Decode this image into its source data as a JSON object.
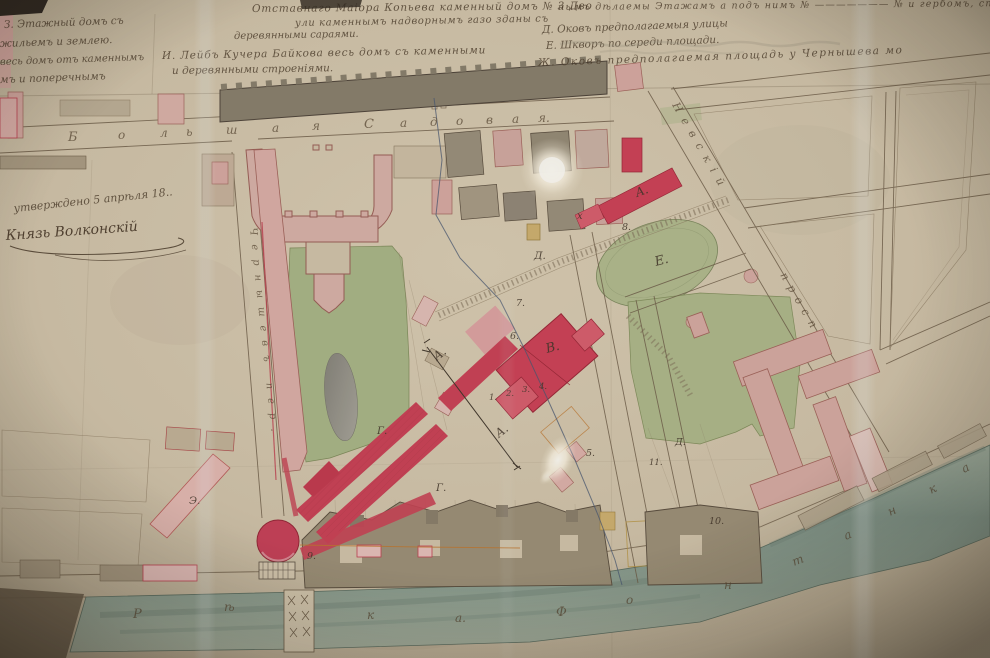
{
  "legend": {
    "left": [
      {
        "t": "З. Этажный домъ съ",
        "x": 4,
        "y": 28,
        "s": 10.5,
        "r": -2
      },
      {
        "t": "жильемъ и землею.",
        "x": 0,
        "y": 47,
        "s": 10.5,
        "r": -2
      },
      {
        "t": "весь домъ отъ каменнымъ",
        "x": 0,
        "y": 65,
        "s": 10,
        "r": -2
      },
      {
        "t": "мъ и поперечнымъ",
        "x": 0,
        "y": 83,
        "s": 10.5,
        "r": -2
      }
    ],
    "center": [
      {
        "t": "Отставнаго Маіора Копьева каменный домъ № 3 Дво",
        "x": 252,
        "y": 12,
        "s": 10.5,
        "r": -0.5,
        "ls": 0.8
      },
      {
        "t": "ули каменнымъ надворнымъ газо зданы съ",
        "x": 295,
        "y": 26,
        "s": 10,
        "r": -1,
        "ls": 0.6
      },
      {
        "t": "деревянными сараями.",
        "x": 234,
        "y": 39,
        "s": 10,
        "r": -1
      },
      {
        "t": "И. Лейбъ Кучера Байкова весь домъ съ каменными",
        "x": 162,
        "y": 59,
        "s": 10.5,
        "r": -1,
        "ls": 0.8
      },
      {
        "t": "и деревянными строеніями.",
        "x": 172,
        "y": 74,
        "s": 10.5,
        "r": -1
      }
    ],
    "right": [
      {
        "t": "нымъ дѣлаемы Этажамъ а подъ нимъ № ——————— № и гербомъ, спр",
        "x": 558,
        "y": 10,
        "s": 9.5,
        "r": -0.5,
        "ls": 1.2
      },
      {
        "t": "Д. Оковъ предполагаемыя улицы",
        "x": 542,
        "y": 33,
        "s": 10.5,
        "r": -2
      },
      {
        "t": "Е. Шкворъ по середи площади.",
        "x": 546,
        "y": 49,
        "s": 10.5,
        "r": -2
      },
      {
        "t": "Ж. Оковъ предполагаемая площадь у Чернышева мо",
        "x": 538,
        "y": 66,
        "s": 10.5,
        "r": -2,
        "ls": 1.5
      }
    ]
  },
  "approval": {
    "line1": "утверждено 5 апрѣля 18..",
    "line2": "Князь Волконскій"
  },
  "street_letters": [
    {
      "t": "Б",
      "x": 68,
      "y": 141,
      "s": 13
    },
    {
      "t": "о",
      "x": 118,
      "y": 139,
      "s": 12
    },
    {
      "t": "л",
      "x": 160,
      "y": 137,
      "s": 12
    },
    {
      "t": "ь",
      "x": 186,
      "y": 136,
      "s": 12
    },
    {
      "t": "ш",
      "x": 226,
      "y": 134,
      "s": 12
    },
    {
      "t": "а",
      "x": 272,
      "y": 132,
      "s": 12
    },
    {
      "t": "я",
      "x": 312,
      "y": 130,
      "s": 12
    },
    {
      "t": "С",
      "x": 364,
      "y": 128,
      "s": 13
    },
    {
      "t": "а",
      "x": 400,
      "y": 127,
      "s": 12
    },
    {
      "t": "д",
      "x": 430,
      "y": 126,
      "s": 12
    },
    {
      "t": "о",
      "x": 456,
      "y": 125,
      "s": 12
    },
    {
      "t": "в",
      "x": 486,
      "y": 124,
      "s": 12
    },
    {
      "t": "а",
      "x": 512,
      "y": 123,
      "s": 12
    },
    {
      "t": "я.",
      "x": 538,
      "y": 122,
      "s": 12
    },
    {
      "t": "Чернышевъ пер.",
      "x": 250,
      "y": 228,
      "s": 10,
      "r": 84,
      "ls": 9
    },
    {
      "t": "Невскій",
      "x": 672,
      "y": 105,
      "s": 11,
      "r": 60,
      "ls": 8
    },
    {
      "t": "просп",
      "x": 780,
      "y": 275,
      "s": 11,
      "r": 60,
      "ls": 7
    },
    {
      "t": "Р",
      "x": 133,
      "y": 618,
      "s": 13
    },
    {
      "t": "ѣ",
      "x": 224,
      "y": 611,
      "s": 12
    },
    {
      "t": "к",
      "x": 367,
      "y": 619,
      "s": 12
    },
    {
      "t": "а.",
      "x": 455,
      "y": 622,
      "s": 12
    },
    {
      "t": "Ф",
      "x": 556,
      "y": 616,
      "s": 13
    },
    {
      "t": "о",
      "x": 626,
      "y": 604,
      "s": 12
    },
    {
      "t": "н",
      "x": 724,
      "y": 589,
      "s": 12
    },
    {
      "t": "т",
      "x": 794,
      "y": 566,
      "s": 12,
      "r": -22
    },
    {
      "t": "а",
      "x": 846,
      "y": 540,
      "s": 12,
      "r": -24
    },
    {
      "t": "н",
      "x": 890,
      "y": 516,
      "s": 12,
      "r": -25
    },
    {
      "t": "к",
      "x": 931,
      "y": 494,
      "s": 12,
      "r": -26
    },
    {
      "t": "а",
      "x": 964,
      "y": 473,
      "s": 12,
      "r": -27
    }
  ],
  "map_labels": [
    {
      "t": "А.",
      "x": 637,
      "y": 197,
      "s": 12,
      "r": -20
    },
    {
      "t": "х",
      "x": 577,
      "y": 219,
      "s": 10
    },
    {
      "t": "8.",
      "x": 622,
      "y": 230,
      "s": 9.5
    },
    {
      "t": "Д.",
      "x": 534,
      "y": 259,
      "s": 10.5
    },
    {
      "t": "Е.",
      "x": 656,
      "y": 266,
      "s": 13,
      "r": -15
    },
    {
      "t": "7.",
      "x": 516,
      "y": 306,
      "s": 9.5
    },
    {
      "t": "6.",
      "x": 510,
      "y": 339,
      "s": 9.5
    },
    {
      "t": "В.",
      "x": 547,
      "y": 353,
      "s": 13,
      "r": -15
    },
    {
      "t": "1.",
      "x": 489,
      "y": 400,
      "s": 8.5
    },
    {
      "t": "2.",
      "x": 506,
      "y": 396,
      "s": 8.5
    },
    {
      "t": "3.",
      "x": 522,
      "y": 392,
      "s": 8.5
    },
    {
      "t": "4.",
      "x": 539,
      "y": 389,
      "s": 8.5
    },
    {
      "t": "А.",
      "x": 437,
      "y": 361,
      "s": 12,
      "r": -38
    },
    {
      "t": "А.",
      "x": 499,
      "y": 438,
      "s": 12,
      "r": -38
    },
    {
      "t": "Г.",
      "x": 377,
      "y": 434,
      "s": 10.5
    },
    {
      "t": "Г.",
      "x": 436,
      "y": 491,
      "s": 10.5
    },
    {
      "t": "5.",
      "x": 586,
      "y": 456,
      "s": 9.5
    },
    {
      "t": "11.",
      "x": 649,
      "y": 465,
      "s": 8.5
    },
    {
      "t": "Д.",
      "x": 675,
      "y": 445,
      "s": 9.5
    },
    {
      "t": "10.",
      "x": 709,
      "y": 524,
      "s": 9.5
    },
    {
      "t": "Э.",
      "x": 189,
      "y": 504,
      "s": 10.5
    },
    {
      "t": "9.",
      "x": 307,
      "y": 559,
      "s": 9.5
    }
  ],
  "colors": {
    "paper": "#d6c9b0",
    "paper_dark": "#b8ab92",
    "ink": "#4c3d2c",
    "line_brown": "#6f5f4a",
    "building_dark": "#89806e",
    "building_tan": "#c3b49a",
    "pink_building": "#d8aba4",
    "pink_outline": "#a2645c",
    "carmine_red": "#c8415a",
    "garden_green": "#aab889",
    "river_teal": "#8ea79b",
    "pond_gray": "#8e8c84",
    "yellow_building": "#d0b271",
    "glass_seam": "#ebf2f4",
    "glow_white": "#fffef8"
  }
}
